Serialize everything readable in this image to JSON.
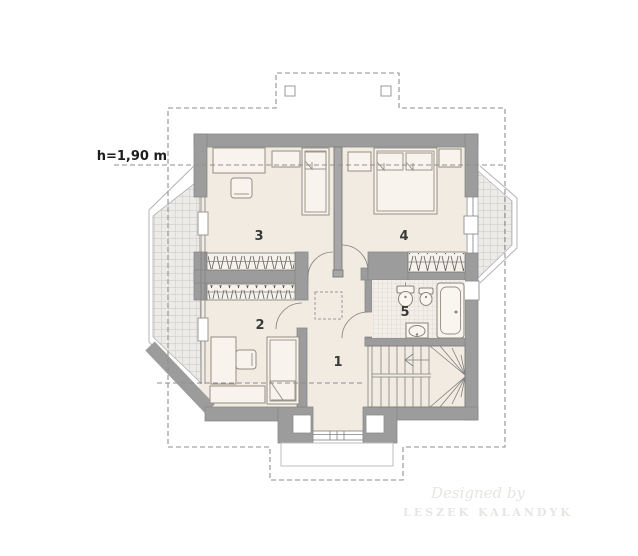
{
  "plan": {
    "height_label": "h=1,90 m",
    "rooms": [
      {
        "label": "1"
      },
      {
        "label": "2"
      },
      {
        "label": "3"
      },
      {
        "label": "4"
      },
      {
        "label": "5"
      }
    ],
    "watermark": {
      "line1": "Designed by",
      "line2": "LESZEK KALANDYK"
    },
    "colors": {
      "wall": "#9c9c9c",
      "floor": "#f1ebe1",
      "furniture": "#f8f4ed",
      "dash": "#8f8f8f",
      "label": "#3a3a3a",
      "watermark": "#e7e5e1"
    }
  }
}
